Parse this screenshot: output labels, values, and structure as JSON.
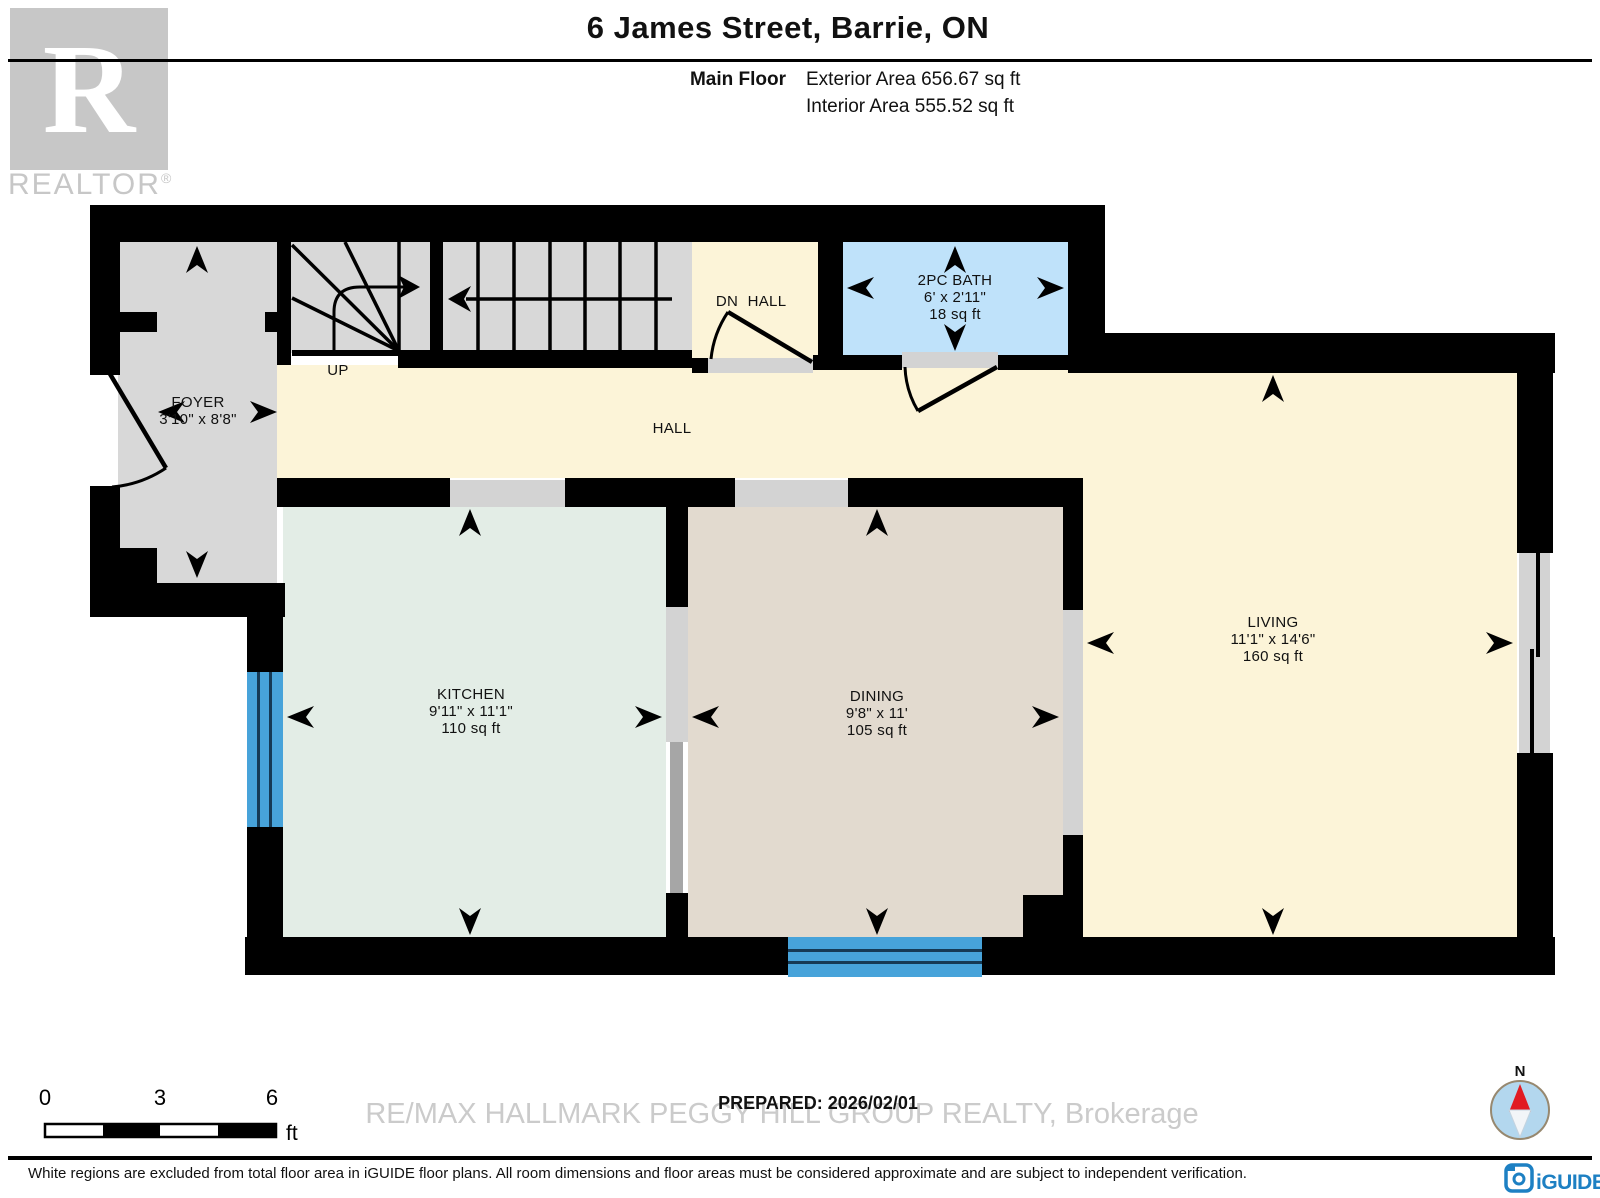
{
  "header": {
    "title": "6 James Street, Barrie, ON",
    "floor_label": "Main Floor",
    "exterior_area": "Exterior Area 656.67 sq ft",
    "interior_area": "Interior Area 555.52 sq ft"
  },
  "branding": {
    "realtor_logo_letter": "R",
    "realtor_logo_text": "REALTOR",
    "registered_mark": "®",
    "watermark": "RE/MAX HALLMARK PEGGY HILL GROUP REALTY, Brokerage",
    "iguide_logo_text": "iGUIDE"
  },
  "rooms": {
    "foyer": {
      "name": "FOYER",
      "dims": "3'10\" x 8'8\""
    },
    "up": {
      "name": "UP"
    },
    "dn": {
      "name": "DN"
    },
    "upper_hall": {
      "name": "HALL"
    },
    "bath": {
      "name": "2PC BATH",
      "dims": "6' x 2'11\"",
      "area": "18 sq ft"
    },
    "hall": {
      "name": "HALL"
    },
    "kitchen": {
      "name": "KITCHEN",
      "dims": "9'11\" x 11'1\"",
      "area": "110 sq ft"
    },
    "dining": {
      "name": "DINING",
      "dims": "9'8\" x 11'",
      "area": "105 sq ft"
    },
    "living": {
      "name": "LIVING",
      "dims": "11'1\" x 14'6\"",
      "area": "160 sq ft"
    }
  },
  "scale_bar": {
    "tick_0": "0",
    "tick_3": "3",
    "tick_6": "6",
    "unit": "ft"
  },
  "compass": {
    "north_label": "N"
  },
  "footer": {
    "prepared": "PREPARED: 2026/02/01",
    "disclaimer": "White regions are excluded from total floor area in iGUIDE floor plans. All room dimensions and floor areas must be considered approximate and are subject to independent verification."
  },
  "colors": {
    "wall": "#000000",
    "foyer_stairs_gray": "#d8d8d8",
    "hall_living_cream": "#fcf4d8",
    "bath_blue": "#bfe2fa",
    "kitchen_green": "#e3ede6",
    "dining_beige": "#e2dacf",
    "window_blue": "#47a3da",
    "threshold_gray": "#d3d3d3",
    "iguide_blue": "#1d80c3",
    "compass_red": "#e11b22",
    "watermark_gray": "#cbcbcb"
  }
}
